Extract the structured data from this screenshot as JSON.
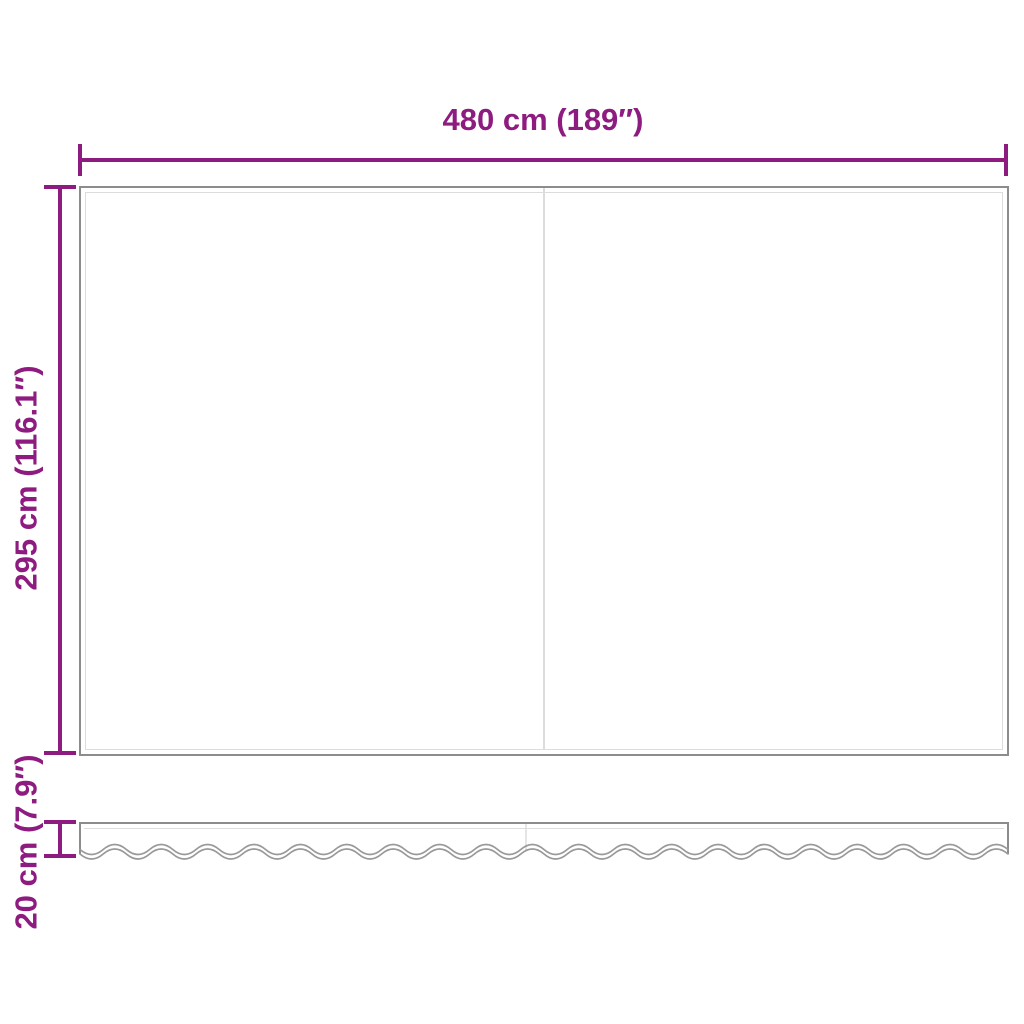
{
  "diagram": {
    "accent_color": "#8e1b7f",
    "outline_color": "#8c8c8c",
    "inner_line_color": "#dcdcdc",
    "scallop_line_color": "#999999",
    "dimensions": {
      "width": {
        "label": "480 cm (189″)"
      },
      "height": {
        "label": "295 cm (116.1″)"
      },
      "valance_height": {
        "label": "20 cm (7.9″)"
      }
    }
  }
}
